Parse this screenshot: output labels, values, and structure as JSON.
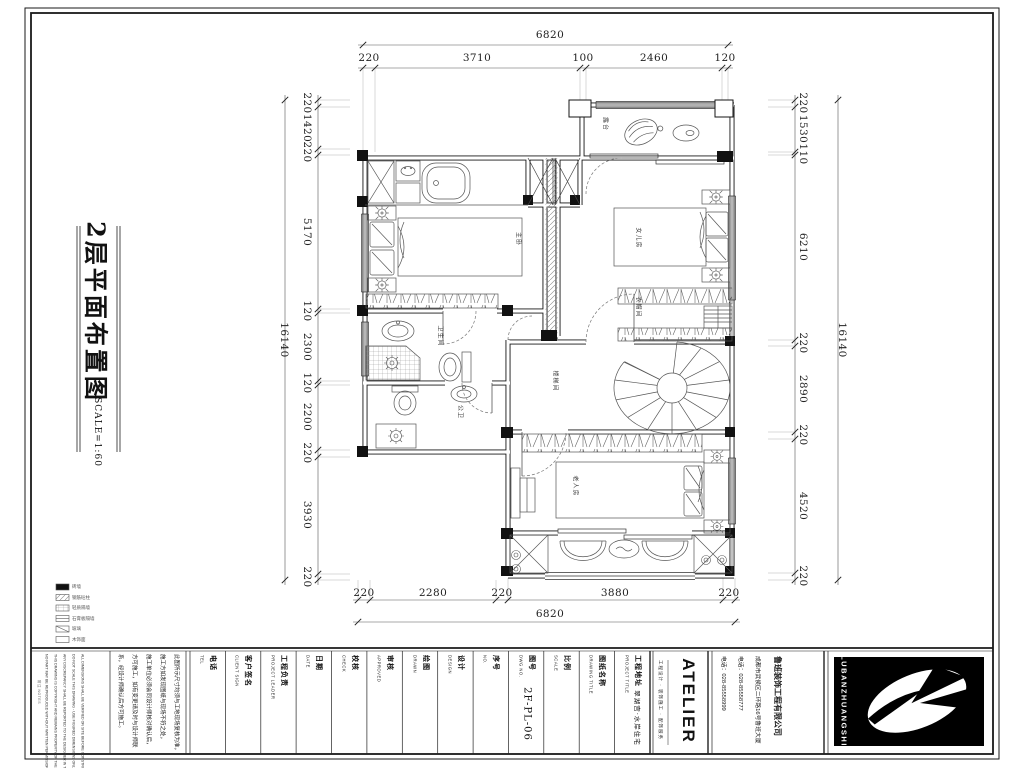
{
  "sheet": {
    "title": "2层平面布置图",
    "scale_note": "SCALE=1:60"
  },
  "dimensions": {
    "top": {
      "overall": "6820",
      "segments": [
        "220",
        "3710",
        "100",
        "2460",
        "120"
      ]
    },
    "bottom": {
      "overall": "6820",
      "segments": [
        "220",
        "2280",
        "220",
        "3880",
        "220"
      ]
    },
    "left": {
      "overall": "16140",
      "segments": [
        "220",
        "1420",
        "220",
        "5170",
        "120",
        "2300",
        "120",
        "2200",
        "220",
        "3930",
        "220"
      ]
    },
    "right": {
      "overall": "16140",
      "segments": [
        "220",
        "1530",
        "110",
        "6210",
        "220",
        "2890",
        "220",
        "4520",
        "220"
      ]
    }
  },
  "rooms": {
    "terrace": "露台",
    "master": "主卧",
    "daughter": "女儿房",
    "bath": "卫生间",
    "wc": "公卫",
    "stair": "楼梯间",
    "cloak": "衣帽间",
    "elder": "老人房"
  },
  "legend": {
    "items": [
      "砖墙",
      "钢筋砼柱",
      "轻质隔墙",
      "石膏板隔墙",
      "玻璃",
      "木饰面"
    ]
  },
  "title_block": {
    "side_note": "附注 NOTES",
    "notes_cn": [
      "此图所示尺寸均须与工地现场复核为准，",
      "施工方如发现图纸与现场不符之处，",
      "施工单位必须会同设计师核对确认后，",
      "方可施工，如有变更请及时与设计师联",
      "系，经设计师确认后方可施工。"
    ],
    "notes_en": [
      "ALL DIMENSIONS SHALL BE VERIFIED ON SITE BEFORE CONSTRUCTION",
      "DO NOT SCALE THIS DRAWING - USE FIGURED DIMENSIONS ONLY",
      "ANY DISCREPANCY SHALL BE REPORTED TO THE DESIGNER IN TIME",
      "THIS DRAWING IS COPYRIGHT AND REMAINS PROPERTY OF THE COMPANY",
      "NO PART MAY BE REPRODUCED WITHOUT WRITTEN PERMISSION"
    ],
    "fields": [
      {
        "label": "电话",
        "sub": "TEL",
        "value": ""
      },
      {
        "label": "客户签名",
        "sub": "CLIENT SIGN",
        "value": ""
      },
      {
        "label": "工程负责",
        "sub": "PROJECT LEADER",
        "value": ""
      },
      {
        "label": "日期",
        "sub": "DATE",
        "value": ""
      },
      {
        "label": "校核",
        "sub": "CHECK",
        "value": ""
      },
      {
        "label": "审核",
        "sub": "APPROVED",
        "value": ""
      },
      {
        "label": "绘图",
        "sub": "DRAWN",
        "value": ""
      },
      {
        "label": "设计",
        "sub": "DESIGN",
        "value": ""
      },
      {
        "label": "序号",
        "sub": "NO.",
        "value": ""
      },
      {
        "label": "图号",
        "sub": "DWG NO.",
        "value": "2F-PL-06"
      },
      {
        "label": "比例",
        "sub": "SCALE",
        "value": ""
      },
      {
        "label": "图纸名称",
        "sub": "DRAWING TITLE",
        "value": ""
      },
      {
        "label": "工程地址",
        "sub": "PROJECT TITLE",
        "value": "翠湖宫·水岸住宅"
      }
    ],
    "atelier": {
      "title": "ATELIER",
      "tagline": "工程设计 · 装饰施工 · 配饰服务"
    },
    "company": {
      "name": "鲁班装饰工程有限公司",
      "address": "成都市武侯区二环路16号鲁班大厦",
      "tel1": "电话：028-85558777",
      "tel2": "电话：028-85558999"
    },
    "logo_text": "LUBANZHUANGSHI"
  }
}
